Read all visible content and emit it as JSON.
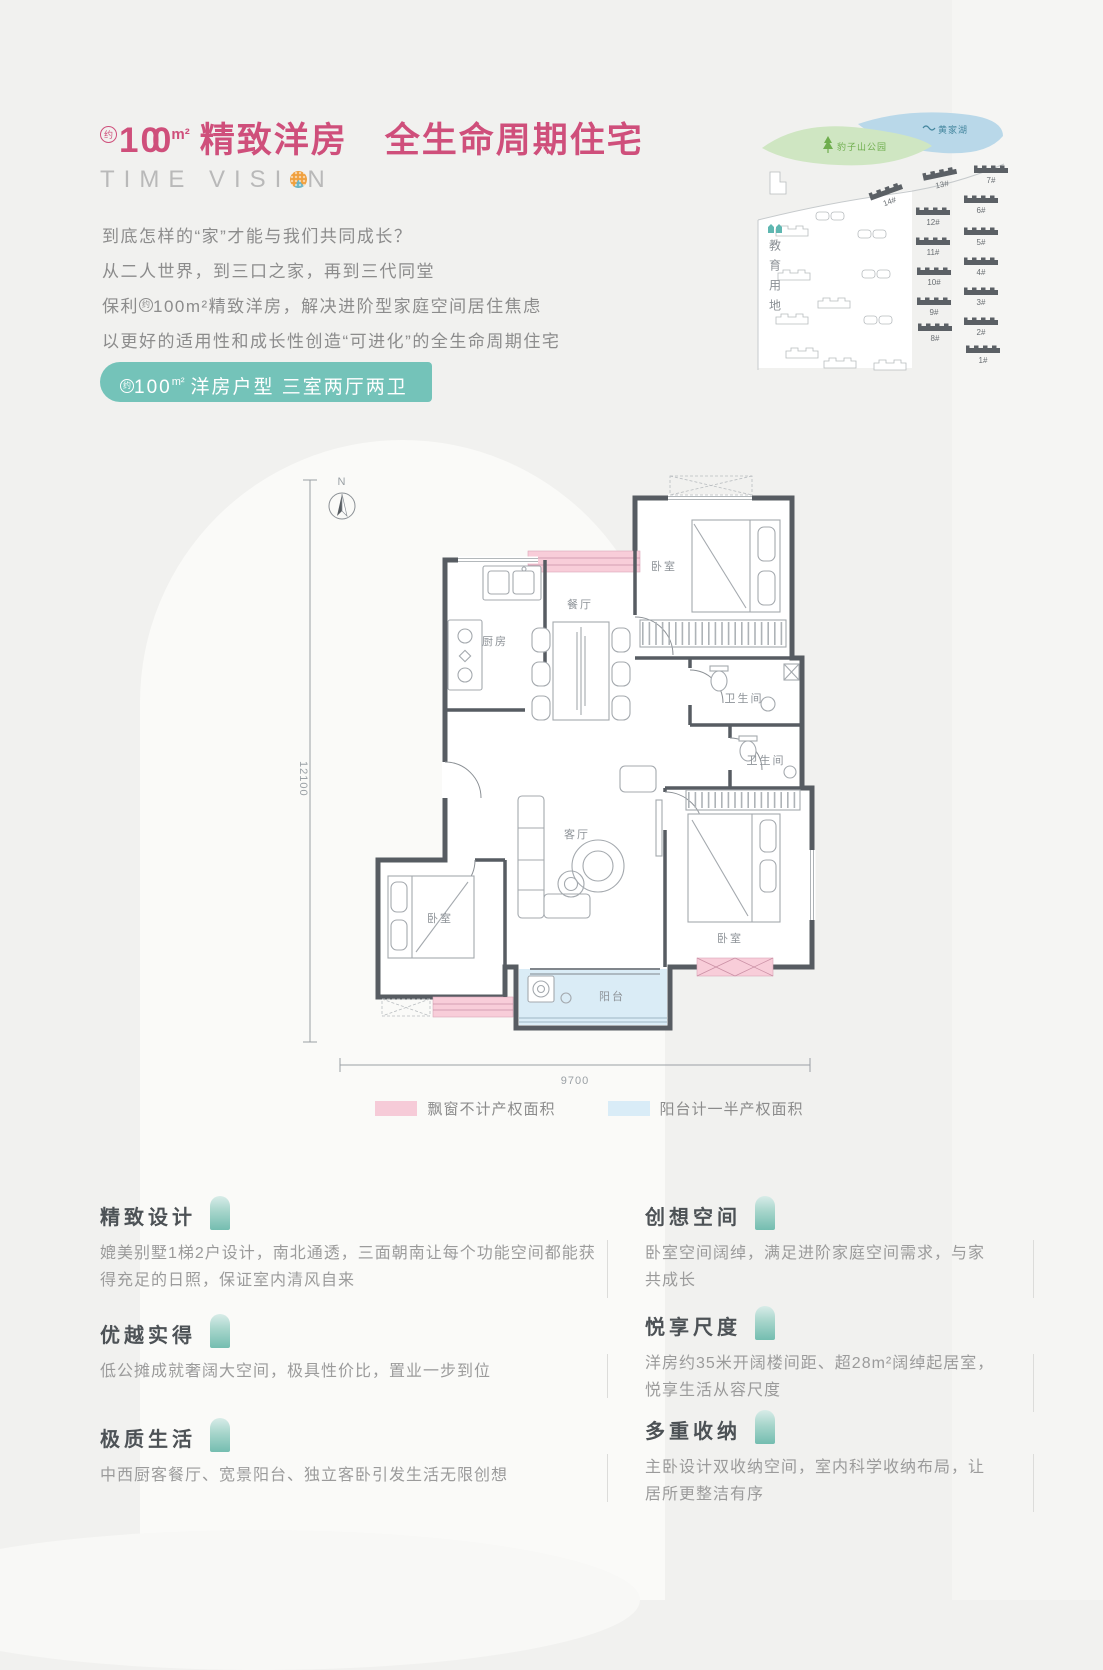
{
  "colors": {
    "accent_pink": "#cf4f7b",
    "badge_teal": "#74c3b9",
    "bay_pink": "#f6cbd8",
    "balcony_blue": "#d9ecf7",
    "wall_dark": "#575c62"
  },
  "header": {
    "approx": "约",
    "area": "1",
    "zeros": "00",
    "unit": "m²",
    "title_rest": "精致洋房　全生命周期住宅",
    "logo_pre": "TIME VISI",
    "logo_post": "N"
  },
  "intro": {
    "line1": "到底怎样的“家”才能与我们共同成长？",
    "line2": "从二人世界，到三口之家，再到三代同堂",
    "line3_prefix": "保利",
    "line3_approx": "约",
    "line3_rest": "100m²精致洋房，解决进阶型家庭空间居住焦虑",
    "line4": "以更好的适用性和成长性创造“可进化”的全生命周期住宅"
  },
  "badge": {
    "approx": "约",
    "area": "100",
    "unit": "m²",
    "text": "洋房户型 三室两厅两卫"
  },
  "site_map": {
    "park_label": "豹子山公园",
    "lake_label": "黄家湖",
    "edu_label": "教育用地",
    "buildings": [
      "14#",
      "13#",
      "7#",
      "12#",
      "6#",
      "11#",
      "5#",
      "10#",
      "4#",
      "9#",
      "3#",
      "8#",
      "2#",
      "1#"
    ]
  },
  "floor_plan": {
    "north": "N",
    "dim_left": "12100",
    "dim_bottom": "9700",
    "labels": {
      "kitchen": "厨房",
      "dining": "餐厅",
      "living": "客厅",
      "bedroom": "卧室",
      "bath": "卫生间",
      "balcony": "阳台"
    },
    "legend": [
      {
        "label": "飘窗不计产权面积"
      },
      {
        "label": "阳台计一半产权面积"
      }
    ]
  },
  "features": {
    "left": [
      {
        "title": "精致设计",
        "body": "媲美别墅1梯2户设计，南北通透，三面朝南让每个功能空间都能获得充足的日照，保证室内清风自来"
      },
      {
        "title": "优越实得",
        "body": "低公摊成就奢阔大空间，极具性价比，置业一步到位"
      },
      {
        "title": "极质生活",
        "body": "中西厨客餐厅、宽景阳台、独立客卧引发生活无限创想"
      }
    ],
    "right": [
      {
        "title": "创想空间",
        "body": "卧室空间阔绰，满足进阶家庭空间需求，与家共成长"
      },
      {
        "title": "悦享尺度",
        "body": "洋房约35米开阔楼间距、超28m²阔绰起居室，悦享生活从容尺度"
      },
      {
        "title": "多重收纳",
        "body": "主卧设计双收纳空间，室内科学收纳布局，让居所更整洁有序"
      }
    ]
  }
}
